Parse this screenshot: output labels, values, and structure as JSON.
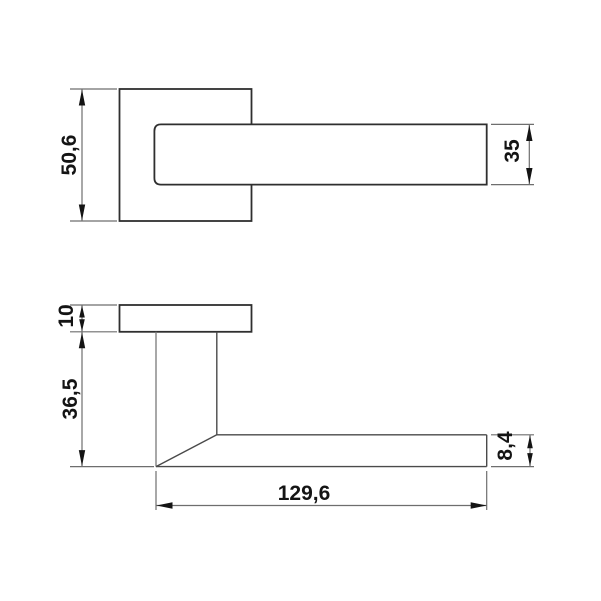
{
  "drawing": {
    "type": "technical-dimension-drawing",
    "subject": "lever door handle with square rosette, top view and side view",
    "units_shown": false,
    "colors": {
      "background": "#ffffff",
      "object_line": "#2f2f2f",
      "dimension_line": "#6e6e6e",
      "text": "#141414"
    }
  },
  "dimensions": {
    "rosette_width": "50,6",
    "lever_bar_width": "35",
    "rosette_thickness": "10",
    "handle_height": "36,5",
    "lever_thickness": "8,4",
    "handle_length": "129,6"
  }
}
